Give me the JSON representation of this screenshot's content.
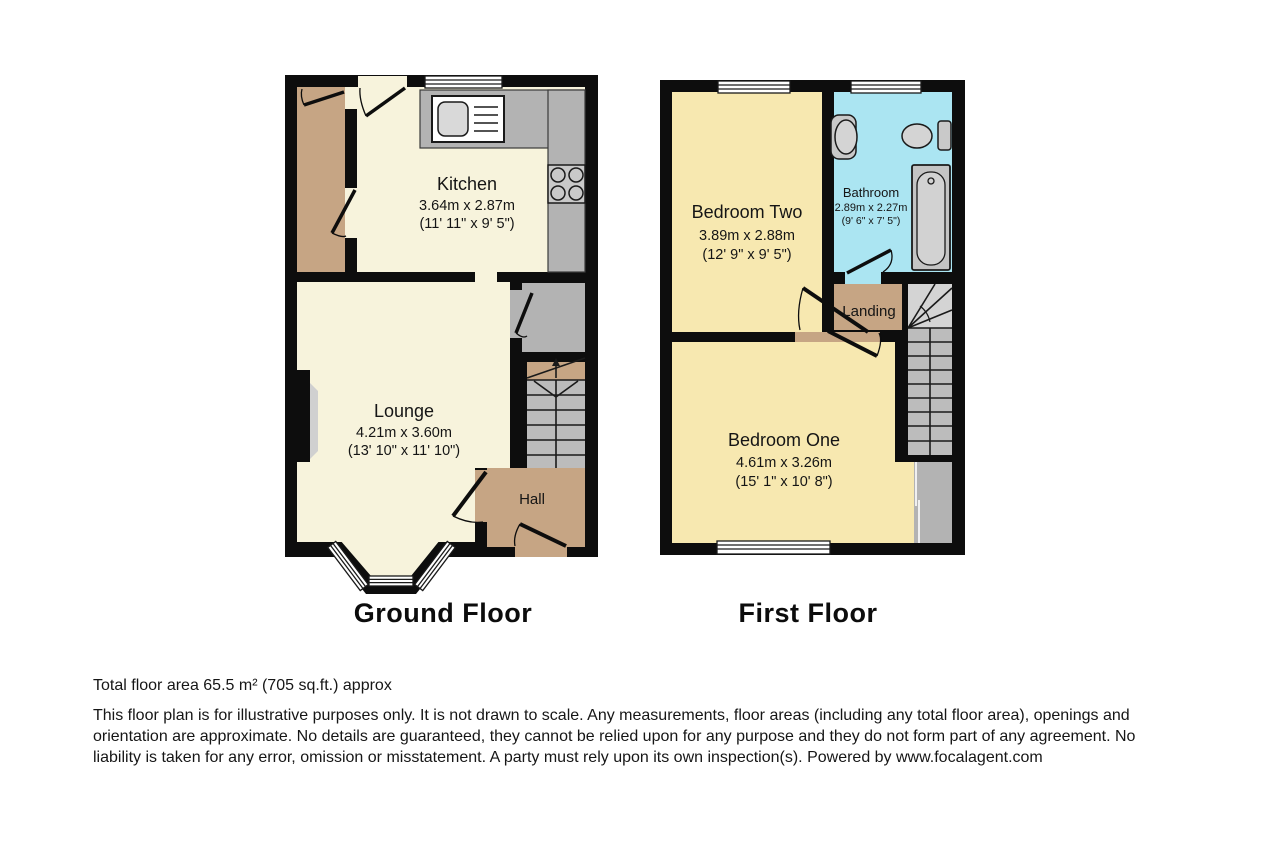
{
  "ground_floor": {
    "title": "Ground Floor",
    "rooms": {
      "kitchen": {
        "name": "Kitchen",
        "metric": "3.64m x 2.87m",
        "imperial": "(11' 11\" x 9' 5\")"
      },
      "lounge": {
        "name": "Lounge",
        "metric": "4.21m x 3.60m",
        "imperial": "(13' 10\" x 11' 10\")"
      },
      "hall": {
        "name": "Hall"
      }
    }
  },
  "first_floor": {
    "title": "First Floor",
    "rooms": {
      "bedroom_two": {
        "name": "Bedroom Two",
        "metric": "3.89m x 2.88m",
        "imperial": "(12' 9\" x 9' 5\")"
      },
      "bathroom": {
        "name": "Bathroom",
        "metric": "2.89m x 2.27m",
        "imperial": "(9' 6\" x 7' 5\")"
      },
      "landing": {
        "name": "Landing"
      },
      "bedroom_one": {
        "name": "Bedroom One",
        "metric": "4.61m x 3.26m",
        "imperial": "(15' 1\" x 10' 8\")"
      }
    }
  },
  "footer": {
    "total_area": "Total floor area 65.5 m² (705 sq.ft.) approx",
    "disclaimer": "This floor plan is for illustrative purposes only. It is not drawn to scale. Any measurements, floor areas (including any total floor area), openings and orientation are approximate. No details are guaranteed, they cannot be relied upon for any purpose and they do not form part of any agreement. No liability is taken for any error, omission or misstatement. A party must rely upon its own inspection(s). Powered by www.focalagent.com"
  },
  "colors": {
    "wall": "#0d0d0d",
    "cream_room": "#f7f3dc",
    "yellow_room": "#f7e8b0",
    "bathroom_blue": "#abe5f2",
    "hall_tan": "#c6a584",
    "fixture_gray": "#b3b3b3",
    "stair_gray": "#bcbcbc"
  }
}
